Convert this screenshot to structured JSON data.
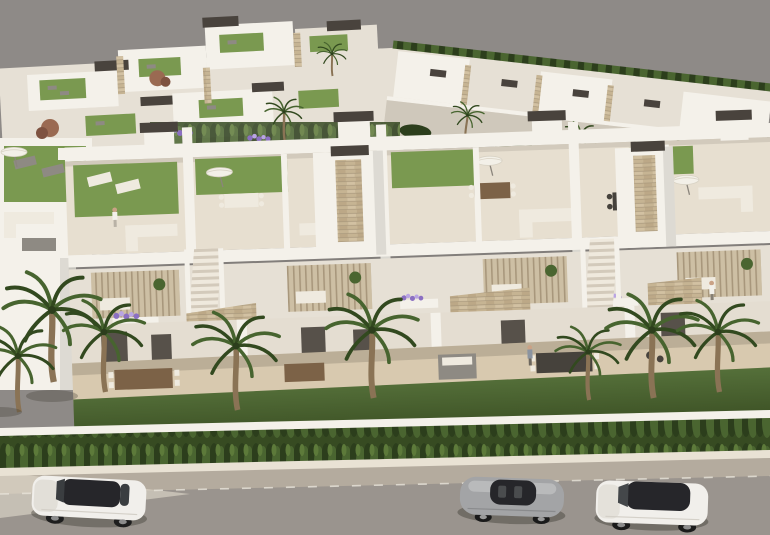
{
  "scene": {
    "type": "architectural-3d-render",
    "subject": "aerial view of a modern white townhouse development with rooftop solarium terraces, palm trees, garden hedge and three cars parked on the street",
    "buildings": [
      "background-villa-cluster",
      "background-villa-row",
      "main-townhouse-row"
    ],
    "rooftop_items": [
      "lawn-patch",
      "sun-lounger",
      "parasol",
      "corner-sofa",
      "dining-table",
      "stair-tower"
    ],
    "street_items": [
      "boundary-wall",
      "hedge-row",
      "sidewalk-curb",
      "parking-lane",
      "asphalt-road",
      "lane-dash-line"
    ],
    "cars": [
      "white-suv",
      "silver-coupe",
      "white-sedan"
    ],
    "people_count": 3,
    "palm_trees_foreground": 8
  },
  "colors": {
    "backdrop": "#8e8a87",
    "wallLit": "#f4f1ea",
    "wallShade": "#e6e0d5",
    "wallDark": "#cfc8bb",
    "floorCream": "#e7dfd0",
    "floorWarm": "#d8c9af",
    "terraceShade": "#c9b99e",
    "stone": "#c6b493",
    "stoneLine": "#b3a184",
    "lawn": "#7a9950",
    "lawnDark": "#55703a",
    "lawnShade": "#36491f",
    "hedge": "#374b22",
    "hedgeDark": "#2c3e1c",
    "hedgeLight": "#4a6530",
    "palmGreen": "#47642f",
    "palmDark": "#32491f",
    "trunk": "#8a7355",
    "capDark": "#49433d",
    "curb": "#e9e2d4",
    "parking": "#b4ab9e",
    "asphalt": "#9a948e",
    "dash": "#e8e4da",
    "carWhite": "#f1efeb",
    "carSilver": "#a3a4a6",
    "glassDark": "#26262a",
    "furnitureWhite": "#efeadf",
    "furnitureGray": "#8e8a83",
    "tableDark": "#46423c",
    "wood": "#7c6247",
    "flowerPurple": "#8b6fc2",
    "flowerLight": "#b9a4e3"
  }
}
